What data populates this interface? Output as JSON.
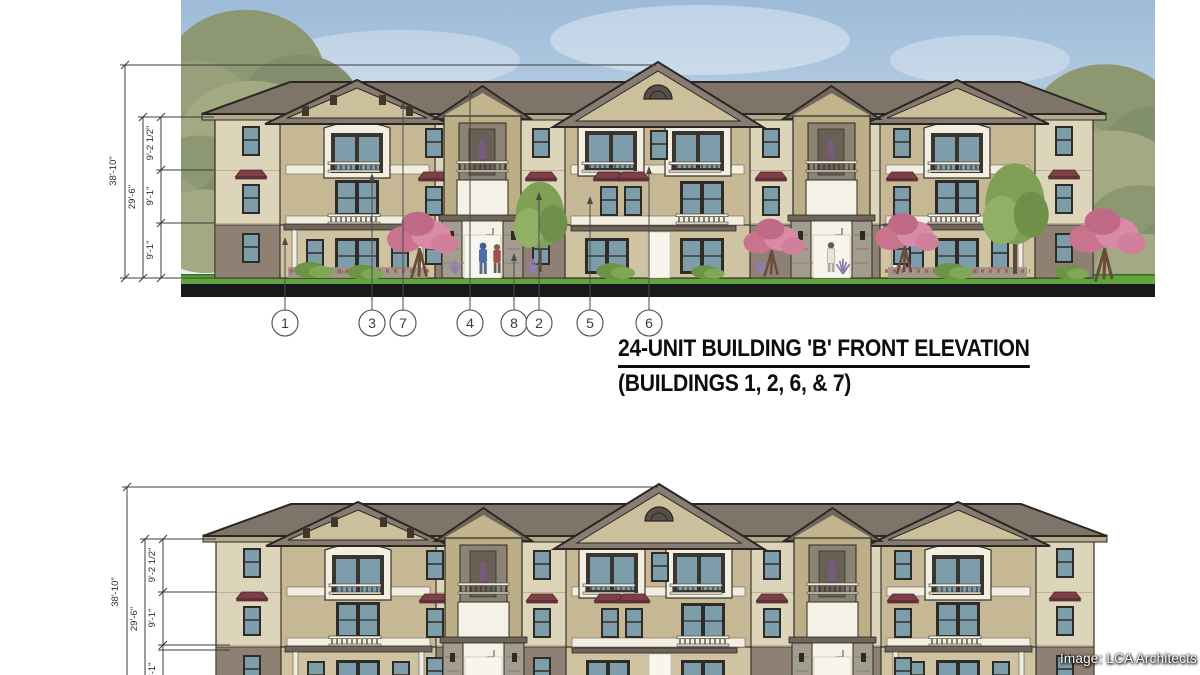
{
  "top_elevation": {
    "dimensions": {
      "overall": "38'-10\"",
      "upper_two": "29'-6\"",
      "third_floor": "9'-2 1/2\"",
      "second_floor": "9'-1\"",
      "first_floor": "9'-1\""
    },
    "callouts": [
      "1",
      "3",
      "7",
      "4",
      "8",
      "2",
      "5",
      "6"
    ],
    "title_line1": "24-UNIT BUILDING 'B' FRONT ELEVATION",
    "title_line2": "(BUILDINGS 1, 2, 6, & 7)"
  },
  "bottom_elevation": {
    "dimensions": {
      "overall": "38'-10\"",
      "upper_two": "29'-6\"",
      "third_floor": "9'-2 1/2\"",
      "second_floor": "9'-1\"",
      "first_floor": "9'-1\""
    }
  },
  "credit": "Image: LCA Architects",
  "colors": {
    "sky": "#a7c3db",
    "roof": "#7d7369",
    "wall_cream": "#ddd5ba",
    "wall_tan": "#c6b894",
    "first_floor_wall": "#8e8174",
    "window_glass": "#7e9dab",
    "awning": "#7d3e46",
    "grass": "#5da33f",
    "ground_band": "#17191c",
    "tree_pink": "#c9738f",
    "tree_green": "#7fa055"
  }
}
